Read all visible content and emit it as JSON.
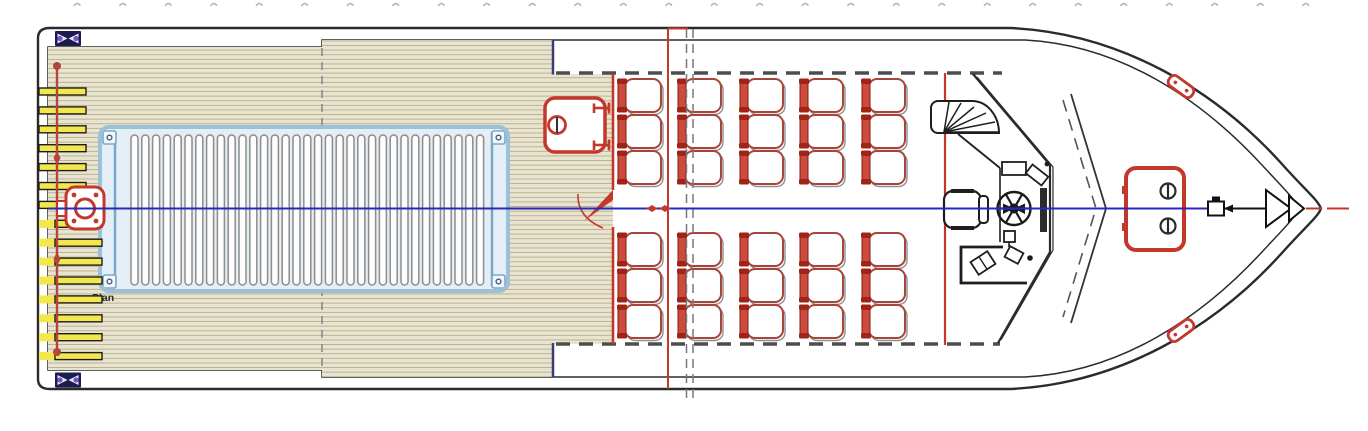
{
  "drawing": {
    "plan_label": "Plan",
    "type": "vessel deck plan (top view)",
    "seating": {
      "columns": 5,
      "rows_per_side": 3,
      "sides": 2,
      "total_seats": 30
    },
    "engine_hatch": {
      "grating_slats": 33
    },
    "stern_steps": {
      "bars": 15
    },
    "colors": {
      "deck_tan": "#e9e4cf",
      "plank_line": "#b6ae8f",
      "outline_dark": "#2b2b2b",
      "red_accent": "#c4372b",
      "seat_red": "#cd4a3c",
      "seat_cap_red": "#a02317",
      "seat_back_edge": "#7e1d12",
      "seat_pan_line": "#a8453a",
      "centerline_blue": "#2929b8",
      "hatch_frame_blue": "#9cc0d8",
      "hatch_fill_blue": "#e3eef6",
      "hinge_bar_blue": "#7aa7c7",
      "step_yellow": "#f2e84d",
      "bollard_navy": "#1b1b4e",
      "bollard_purple": "#7753cf",
      "dash_gray": "#4d4d4d",
      "survey_red": "#b5443c"
    }
  },
  "geometry": {
    "top_marks": {
      "x0": 74,
      "pitch": 45.5,
      "count": 28
    },
    "stern_bars": {
      "x": 39,
      "y0": 88,
      "pitch": 18.9,
      "count": 15,
      "w_short": 47,
      "w_long": 63,
      "h": 7,
      "long_from_index": 7,
      "long_offset_x": 16
    },
    "grating": {
      "x0": 131,
      "y": 135,
      "slat_width": 7,
      "height": 150,
      "pitch": 10.8,
      "count": 33
    },
    "seat_columns_x": [
      618,
      678,
      740,
      800,
      862
    ],
    "seat_rows_top_y": [
      79,
      115,
      151
    ],
    "seat_rows_bottom_y": [
      233,
      269,
      305
    ],
    "seat_pan": {
      "w": 36,
      "h": 33,
      "rx": 8
    }
  }
}
